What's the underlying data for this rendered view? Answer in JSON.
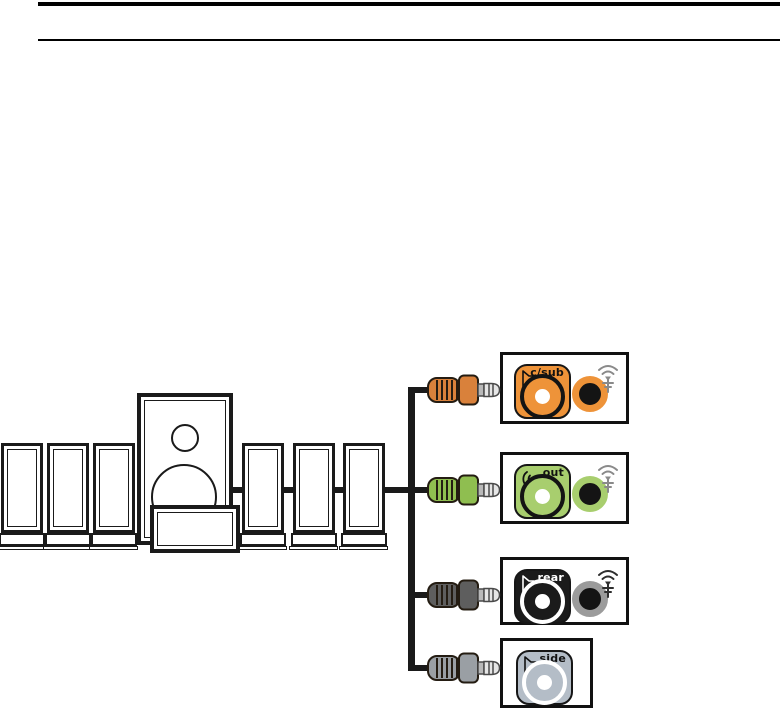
{
  "header": {
    "rule_count": 2
  },
  "diagram": {
    "cable_color": "#1A1A1A",
    "speakers": {
      "left_satellites": 3,
      "right_satellites": 3,
      "subwoofer": 1,
      "center_speaker": 1
    },
    "panels": [
      {
        "label": "c/sub",
        "label_color": "#111111",
        "accent": "#EE9339",
        "jack_ring": "#141414",
        "icon": "speaker-icon",
        "icon_color": "#111111",
        "antenna_icon": true,
        "antenna_color": "#8A8A8A",
        "right_jack": {
          "ring": "#EE9339",
          "center": "#141414"
        },
        "plug_color": "#D9813B"
      },
      {
        "label": "out",
        "label_color": "#111111",
        "accent": "#A8CE6E",
        "jack_ring": "#141414",
        "icon": "audio-out-icon",
        "icon_color": "#111111",
        "antenna_icon": true,
        "antenna_color": "#8A8A8A",
        "right_jack": {
          "ring": "#A8CE6E",
          "center": "#141414"
        },
        "plug_color": "#8FBE50"
      },
      {
        "label": "rear",
        "label_color": "#FFFFFF",
        "accent": "#1B1B1B",
        "jack_ring": "#FFFFFF",
        "icon": "speaker-icon",
        "icon_color": "#FFFFFF",
        "antenna_icon": true,
        "antenna_color": "#2E2E2E",
        "right_jack": {
          "ring": "#9B9B9B",
          "center": "#141414"
        },
        "plug_color": "#5E5E5E"
      },
      {
        "label": "side",
        "label_color": "#111111",
        "accent": "#B4BDC7",
        "jack_ring": "#FFFFFF",
        "icon": "speaker-icon",
        "icon_color": "#111111",
        "antenna_icon": false,
        "right_jack": null,
        "plug_color": "#9A9FA4"
      }
    ]
  }
}
